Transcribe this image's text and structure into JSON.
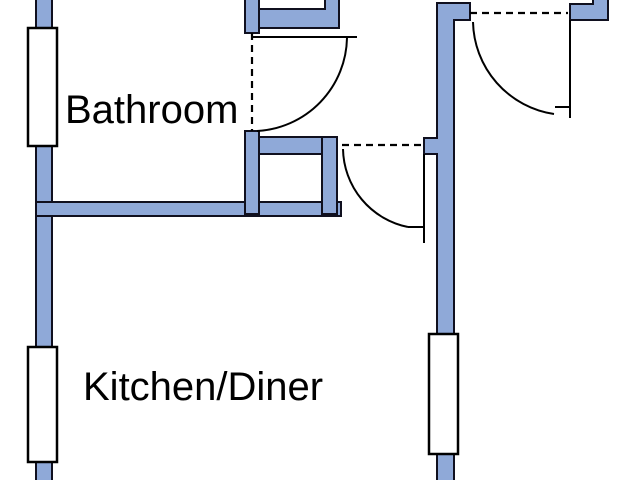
{
  "plan": {
    "rooms": [
      {
        "label": "Bathroom"
      },
      {
        "label": "Kitchen/Diner"
      }
    ],
    "windows": [
      "bathroom-window",
      "kitchen-window",
      "hall-window"
    ],
    "doors": [
      "bathroom-door",
      "kitchen-doorway-door",
      "hall-door"
    ]
  },
  "colors": {
    "background": "#FFFFFF",
    "wall-fill": "#8FA9D8",
    "wall-outline": "#10101F",
    "window-fill": "#FFFFFF",
    "window-outline": "#000000",
    "door-line": "#000000",
    "label-text": "#000000"
  }
}
